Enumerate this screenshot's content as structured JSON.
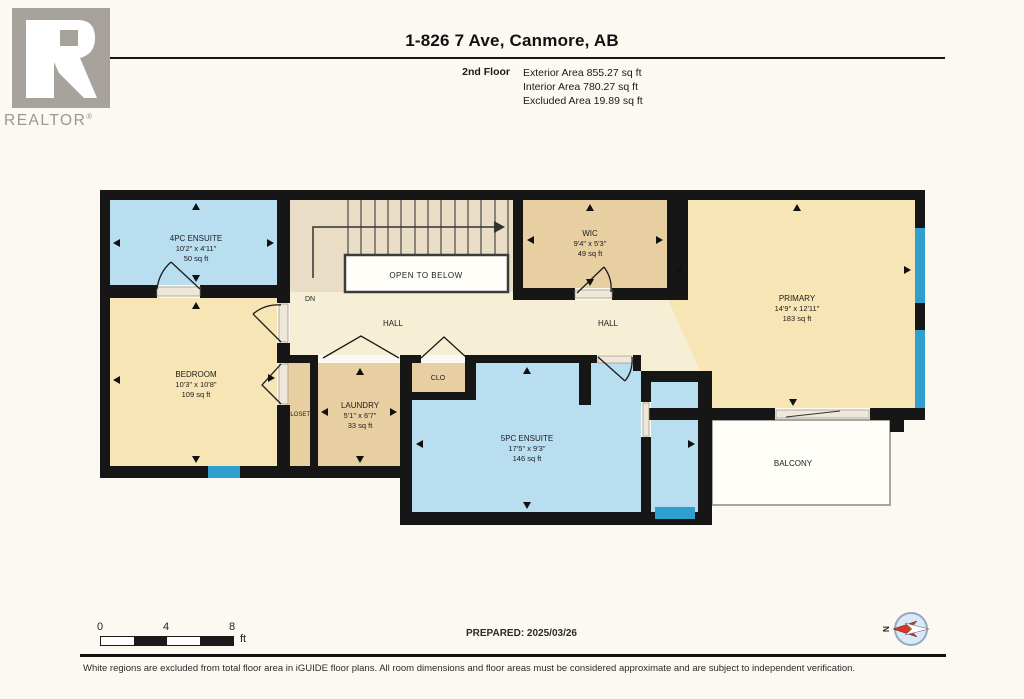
{
  "header": {
    "logo_text": "REALTOR",
    "logo_reg": "®",
    "title": "1-826 7 Ave, Canmore, AB",
    "floor_label": "2nd Floor",
    "stats": [
      "Exterior Area 855.27 sq ft",
      "Interior Area 780.27 sq ft",
      "Excluded Area 19.89 sq ft"
    ]
  },
  "rooms": {
    "ensuite4": {
      "name": "4PC ENSUITE",
      "dims": "10'2\" x 4'11\"",
      "area": "50 sq ft"
    },
    "wic": {
      "name": "WIC",
      "dims": "9'4\" x 5'3\"",
      "area": "49 sq ft"
    },
    "primary": {
      "name": "PRIMARY",
      "dims": "14'9\" x 12'11\"",
      "area": "183 sq ft"
    },
    "bedroom": {
      "name": "BEDROOM",
      "dims": "10'3\" x 10'8\"",
      "area": "109 sq ft"
    },
    "laundry": {
      "name": "LAUNDRY",
      "dims": "5'1\" x 6'7\"",
      "area": "33 sq ft"
    },
    "ensuite5": {
      "name": "5PC ENSUITE",
      "dims": "17'5\" x 9'3\"",
      "area": "146 sq ft"
    }
  },
  "labels": {
    "open_to_below": "OPEN TO BELOW",
    "dn": "DN",
    "hall_left": "HALL",
    "hall_right": "HALL",
    "closet": "CLOSET",
    "clo": "CLO",
    "balcony": "BALCONY",
    "compass_north": "N"
  },
  "footer": {
    "scale_ticks": [
      "0",
      "4",
      "8"
    ],
    "scale_unit": "ft",
    "prepared": "PREPARED: 2025/03/26",
    "disclaimer": "White regions are excluded from total floor area in iGUIDE floor plans. All room dimensions and floor areas must be considered approximate and are subject to independent verification."
  },
  "colors": {
    "room_blue": "#b9def0",
    "room_tan": "#f8e5b5",
    "room_dark_tan": "#e8cfa2",
    "hall_cream": "#f7eed6",
    "stairs_tan": "#e9ddc5",
    "wall_black": "#161616",
    "window_blue": "#2f9fce",
    "compass_red": "#d8352a",
    "logo_gray": "#a7a39c"
  }
}
